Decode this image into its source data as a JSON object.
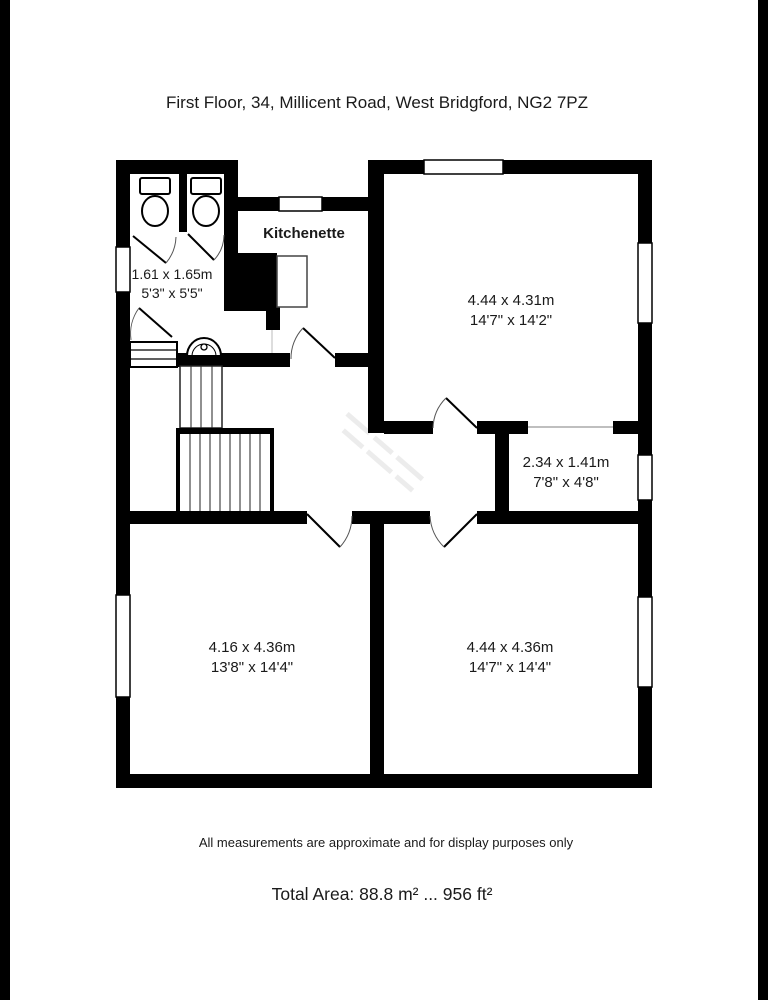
{
  "title": "First Floor, 34, Millicent Road, West Bridgford, NG2 7PZ",
  "footer": {
    "disclaimer": "All measurements are approximate and for display purposes only",
    "total_area": "Total Area: 88.8 m² ... 956 ft²"
  },
  "rooms": {
    "wc_lobby": {
      "metric": "1.61 x 1.65m",
      "imperial": "5'3\" x 5'5\""
    },
    "kitchenette": {
      "name": "Kitchenette"
    },
    "top_right": {
      "metric": "4.44 x 4.31m",
      "imperial": "14'7\" x 14'2\""
    },
    "store": {
      "metric": "2.34 x 1.41m",
      "imperial": "7'8\" x 4'8\""
    },
    "bottom_left": {
      "metric": "4.16 x 4.36m",
      "imperial": "13'8\" x 14'4\""
    },
    "bottom_right": {
      "metric": "4.44 x 4.36m",
      "imperial": "14'7\" x 14'4\""
    }
  },
  "colors": {
    "wall": "#000000",
    "text": "#1a1a1a",
    "background": "#ffffff",
    "pillarbox": "#000000"
  }
}
